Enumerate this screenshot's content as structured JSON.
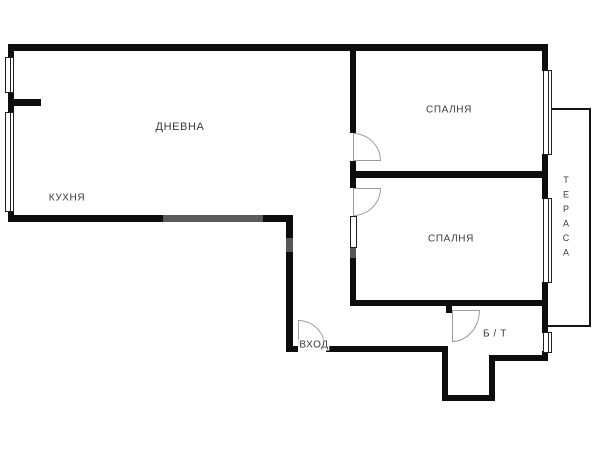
{
  "palette": {
    "wall": "#0d0d0d",
    "thin_line": "#141414",
    "window_border": "#1f1f1f",
    "door_arc": "#9c9c9c",
    "text": "#3b3b3b",
    "background": "#ffffff"
  },
  "rooms": {
    "living": {
      "label": "ДНЕВНА"
    },
    "kitchen": {
      "label": "КУХНЯ"
    },
    "bedroom1": {
      "label": "СПАЛНЯ"
    },
    "bedroom2": {
      "label": "СПАЛНЯ"
    },
    "bath": {
      "label": "Б / Т"
    },
    "entry": {
      "label": "ВХОД"
    },
    "terrace": {
      "label": "ТЕРАСА"
    }
  },
  "geometry": {
    "walls": [
      {
        "name": "wall-top",
        "rect": [
          8,
          44,
          540,
          7
        ]
      },
      {
        "name": "wall-left-upper",
        "rect": [
          8,
          44,
          6,
          15
        ]
      },
      {
        "name": "wall-left-mid",
        "rect": [
          8,
          91,
          6,
          22
        ]
      },
      {
        "name": "wall-left-lower",
        "rect": [
          8,
          210,
          6,
          12
        ]
      },
      {
        "name": "wall-kitchen-stub",
        "rect": [
          8,
          99,
          33,
          7
        ]
      },
      {
        "name": "wall-living-bottom",
        "rect": [
          8,
          215,
          285,
          7
        ]
      },
      {
        "name": "wall-hall-left",
        "rect": [
          286,
          215,
          7,
          137
        ]
      },
      {
        "name": "wall-entry-left-seg",
        "rect": [
          286,
          346,
          12,
          6
        ]
      },
      {
        "name": "wall-entry",
        "rect": [
          326,
          346,
          122,
          6
        ]
      },
      {
        "name": "wall-pocket-left",
        "rect": [
          442,
          346,
          6,
          55
        ]
      },
      {
        "name": "wall-pocket-bottom",
        "rect": [
          442,
          395,
          53,
          6
        ]
      },
      {
        "name": "wall-pocket-right",
        "rect": [
          489,
          356,
          6,
          45
        ]
      },
      {
        "name": "wall-bath-bottom",
        "rect": [
          489,
          355,
          59,
          6
        ]
      },
      {
        "name": "wall-right-1",
        "rect": [
          542,
          44,
          6,
          27
        ]
      },
      {
        "name": "wall-right-2",
        "rect": [
          542,
          154,
          6,
          45
        ]
      },
      {
        "name": "wall-right-3",
        "rect": [
          542,
          282,
          6,
          51
        ]
      },
      {
        "name": "wall-right-4",
        "rect": [
          542,
          351,
          6,
          10
        ]
      },
      {
        "name": "wall-bedrooms-left-1",
        "rect": [
          350,
          44,
          6,
          89
        ]
      },
      {
        "name": "wall-bedrooms-left-2",
        "rect": [
          350,
          161,
          6,
          27
        ]
      },
      {
        "name": "wall-bedrooms-left-3",
        "rect": [
          350,
          216,
          6,
          90
        ]
      },
      {
        "name": "wall-bedroom-divider",
        "rect": [
          356,
          171,
          186,
          7
        ]
      },
      {
        "name": "wall-bedroom2-bottom",
        "rect": [
          350,
          300,
          198,
          6
        ]
      },
      {
        "name": "wall-bathdoor-stub",
        "rect": [
          446,
          306,
          6,
          7
        ]
      }
    ],
    "windows": [
      {
        "name": "window-living-left",
        "rect": [
          5,
          57,
          9,
          36
        ]
      },
      {
        "name": "window-kitchen-left",
        "rect": [
          5,
          112,
          9,
          100
        ]
      },
      {
        "name": "window-bedroom1-right",
        "rect": [
          543,
          70,
          9,
          85
        ]
      },
      {
        "name": "window-bedroom2-right",
        "rect": [
          543,
          198,
          9,
          85
        ]
      },
      {
        "name": "window-bath-right",
        "rect": [
          543,
          332,
          9,
          21
        ]
      }
    ],
    "overlays": [
      {
        "name": "door-leaf-bedroom2",
        "rect": [
          350,
          216,
          7,
          32
        ]
      }
    ],
    "doors": [
      {
        "name": "door-arc-bedroom1",
        "rect": [
          353,
          133,
          28,
          28
        ],
        "corner": "tr"
      },
      {
        "name": "door-arc-bedroom2",
        "rect": [
          353,
          188,
          28,
          28
        ],
        "corner": "br"
      },
      {
        "name": "door-arc-bath",
        "rect": [
          452,
          310,
          28,
          32
        ],
        "corner": "br"
      },
      {
        "name": "door-arc-entry",
        "rect": [
          298,
          320,
          27,
          26
        ],
        "corner": "tr"
      }
    ],
    "terrace_lines": [
      {
        "name": "terrace-line-top",
        "rect": [
          548,
          108,
          43,
          2
        ]
      },
      {
        "name": "terrace-line-right",
        "rect": [
          589,
          108,
          2,
          219
        ]
      },
      {
        "name": "terrace-line-bottom",
        "rect": [
          548,
          325,
          43,
          2
        ]
      }
    ],
    "smudges": [
      {
        "name": "watermark-smudge-1",
        "rect": [
          163,
          215,
          100,
          7
        ],
        "color": "rgba(255,255,255,0.32)"
      },
      {
        "name": "watermark-smudge-2",
        "rect": [
          286,
          238,
          9,
          14
        ],
        "color": "rgba(255,255,255,0.30)"
      },
      {
        "name": "watermark-smudge-3",
        "rect": [
          350,
          248,
          7,
          10
        ],
        "color": "rgba(255,255,255,0.30)"
      }
    ]
  }
}
